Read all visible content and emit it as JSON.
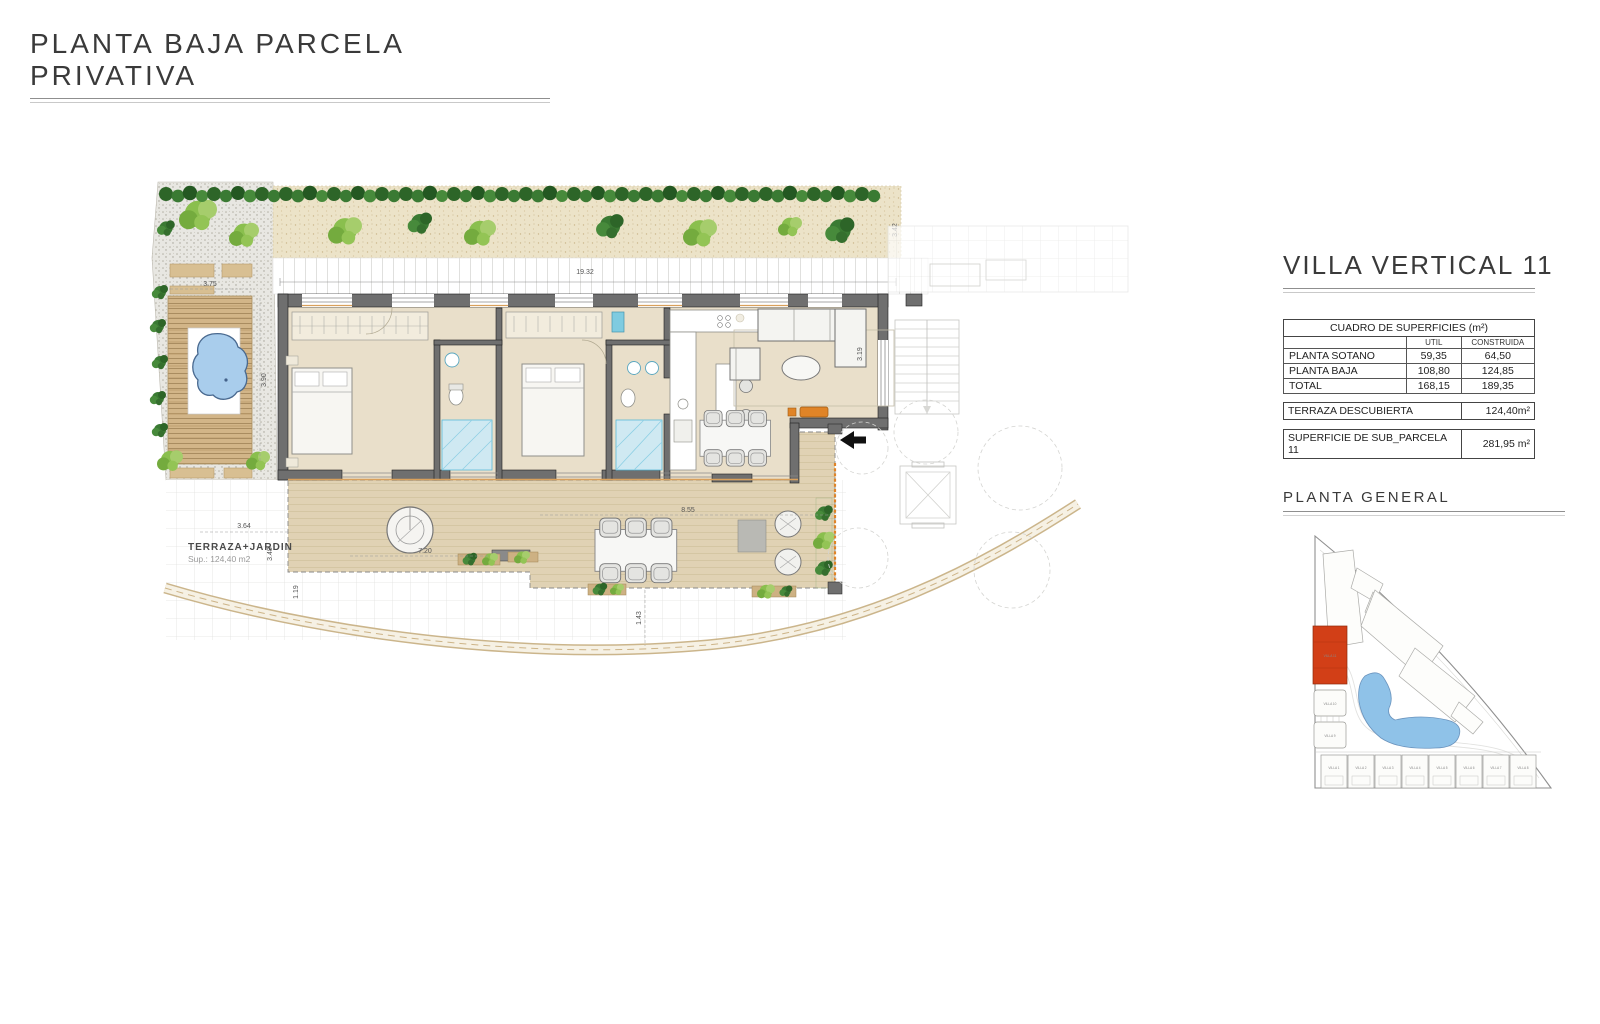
{
  "page": {
    "title": "PLANTA BAJA PARCELA PRIVATIVA"
  },
  "panel": {
    "title": "VILLA VERTICAL 11",
    "table": {
      "header": "CUADRO DE SUPERFICIES (m²)",
      "col_util": "UTIL",
      "col_construida": "CONSTRUIDA",
      "rows": [
        {
          "label": "PLANTA SOTANO",
          "util": "59,35",
          "construida": "64,50"
        },
        {
          "label": "PLANTA BAJA",
          "util": "108,80",
          "construida": "124,85"
        },
        {
          "label": "TOTAL",
          "util": "168,15",
          "construida": "189,35"
        }
      ]
    },
    "terraza": {
      "label": "TERRAZA DESCUBIERTA",
      "value": "124,40m²"
    },
    "superficie": {
      "label": "SUPERFICIE DE SUB_PARCELA 11",
      "value": "281,95 m²"
    },
    "site_title": "PLANTA  GENERAL"
  },
  "plan": {
    "terrace_label": "TERRAZA+JARDIN",
    "terrace_sup": "Sup.: 124,40 m2",
    "dims": {
      "top": "19.32",
      "hedge_right": "3.42",
      "deck_w": "3.75",
      "deck_h": "3.90",
      "terrace_w": "3.64",
      "terrace_h": "3.48",
      "gap": "1.19",
      "left_terrace": "7.20",
      "right_terrace": "8.55",
      "path": "1.43",
      "living": "3.19"
    }
  },
  "site": {
    "red_label": "VILLA 11",
    "left_villas": [
      "VILLA 10",
      "VILLA 9"
    ],
    "villas": [
      "VILLA 1",
      "VILLA 2",
      "VILLA 3",
      "VILLA 4",
      "VILLA 5",
      "VILLA 6",
      "VILLA 7",
      "VILLA 8"
    ]
  },
  "colors": {
    "accent_red": "#d23f17",
    "interior": "#e9dfca",
    "terrace": "#e0d2b4",
    "pool": "#a9cdec",
    "orange": "#e08427",
    "wall": "#6f6f6f"
  }
}
